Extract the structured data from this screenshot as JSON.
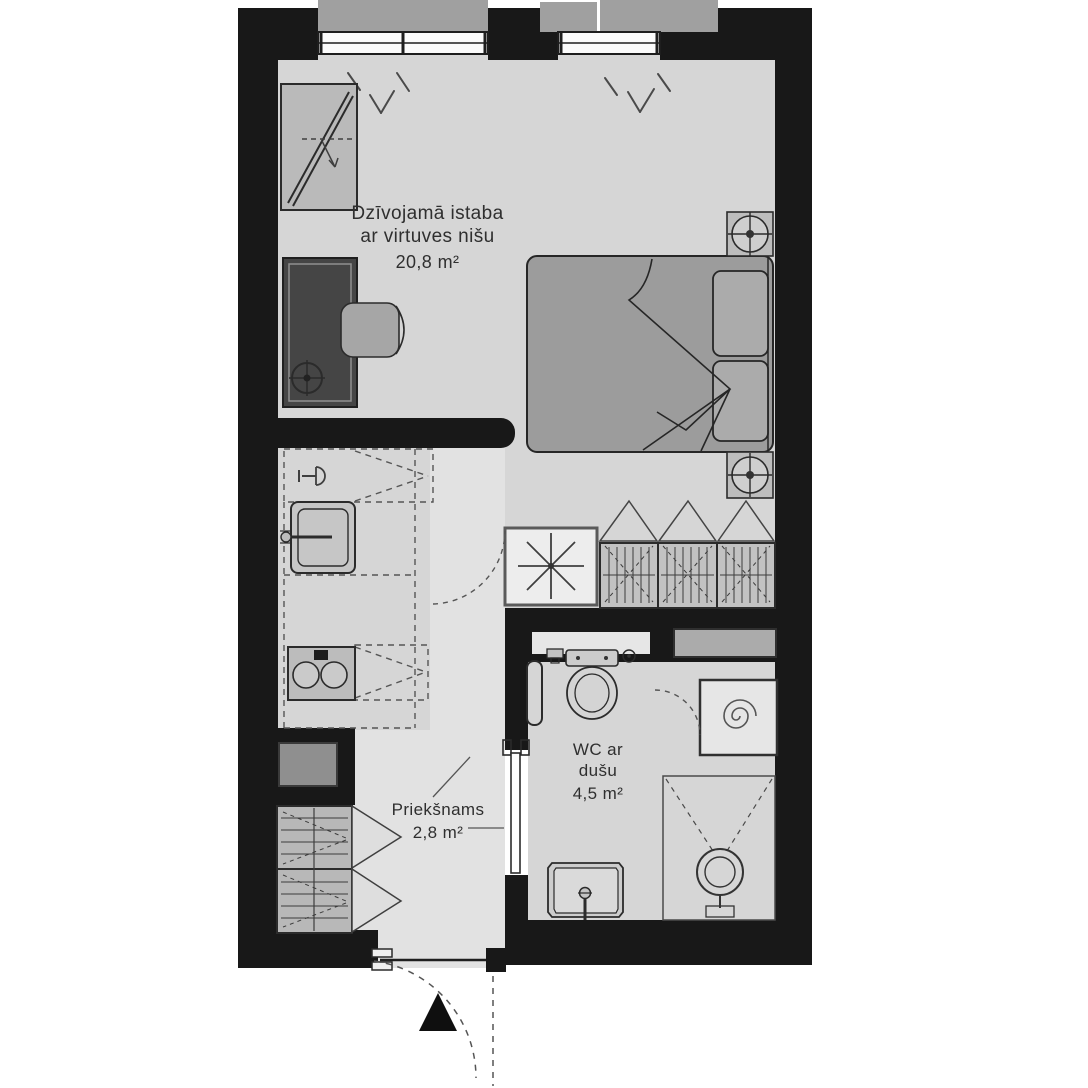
{
  "plan_title": "apartment-floor-plan",
  "rooms": {
    "living": {
      "name_line1": "Dzīvojamā istaba",
      "name_line2": "ar virtuves nišu",
      "area": "20,8 m²"
    },
    "hall": {
      "name": "Priekšnams",
      "area": "2,8 m²"
    },
    "wc": {
      "name_line1": "WC ar",
      "name_line2": "dušu",
      "area": "4,5 m²"
    }
  },
  "colors": {
    "wall": "#181818",
    "floor": "#d6d6d6",
    "floor_light": "#e2e2e2",
    "furniture": "#b8b8b8",
    "outline": "#2b2b2b",
    "text": "#2f2f2f"
  },
  "fixtures": [
    "window",
    "wardrobe",
    "desk",
    "chair",
    "floor-lamp",
    "double-bed",
    "pillow",
    "blanket",
    "bedside-table",
    "table-lamp",
    "kitchen-sink",
    "faucet",
    "stove",
    "fridge-space",
    "ventilation-shaft",
    "hanging-wardrobe",
    "toilet",
    "towel-rail",
    "shower-tray",
    "shower-drain",
    "washing-machine",
    "washbasin",
    "hall-closet",
    "electrical-panel",
    "entrance-door",
    "sliding-door",
    "entrance-arrow"
  ]
}
